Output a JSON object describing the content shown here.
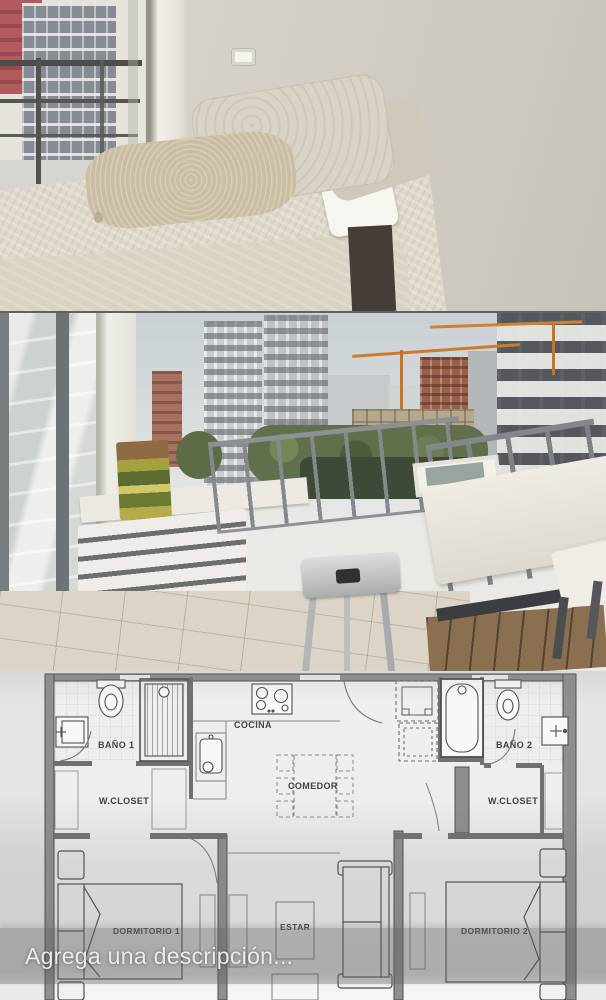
{
  "app": {
    "caption": {
      "placeholder": "Agrega una descripción...",
      "text_color": "#ebebeb",
      "scrim_color": "rgba(98,98,98,0.36)"
    }
  },
  "floor_plan": {
    "labels": {
      "bano_1": "BAÑO 1",
      "w_closet_left": "W.CLOSET",
      "cocina": "COCINA",
      "comedor": "COMEDOR",
      "bano_2": "BAÑO 2",
      "w_closet_right": "W.CLOSET",
      "dormitorio_1": "DORMITORIO 1",
      "estar": "ESTAR",
      "dormitorio_2": "DORMITORIO 2"
    },
    "line_color": "#4a4a4a",
    "wall_fill": "#8f8f8f",
    "paper_color": "#eaeae8"
  },
  "colors": {
    "crane_orange": "#cd7c2c",
    "bedroom_wall": "#d3cfc6",
    "sky": "#c9d0d4",
    "greenery": "#61704a",
    "wood_deck": "#8a6f50"
  }
}
